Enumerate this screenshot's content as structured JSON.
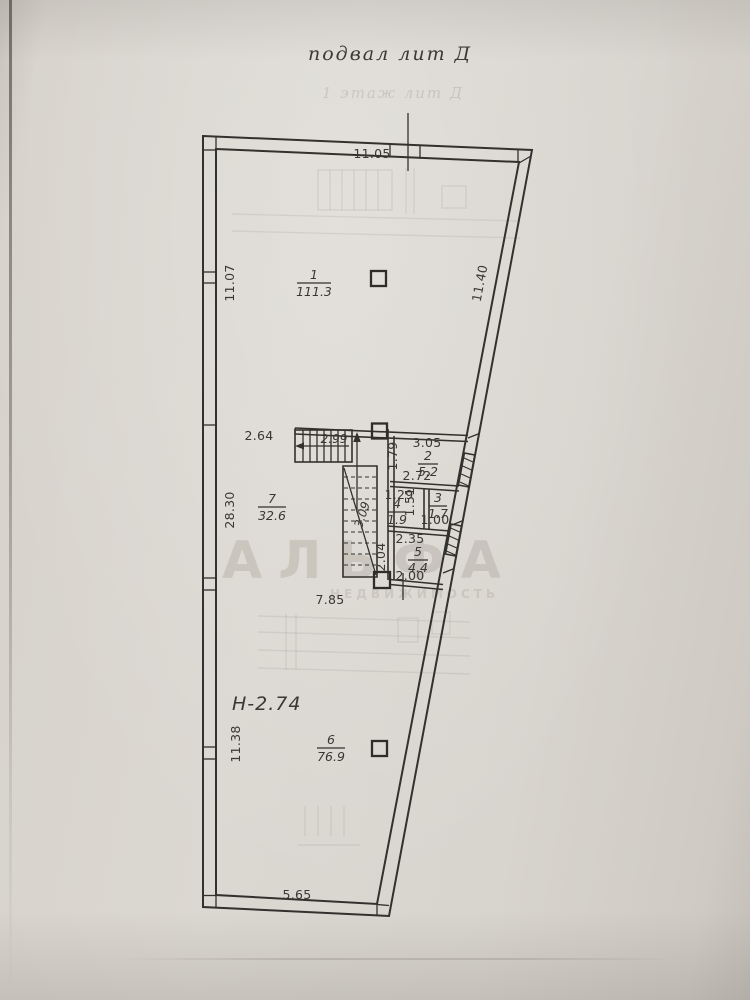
{
  "title": "подвал лит Д",
  "ghost": {
    "title": "1 этаж лит Д"
  },
  "watermark": {
    "line1": "АЛЬФА",
    "line2": "НЕДВИЖИМОСТЬ"
  },
  "notes": {
    "height": "Н-2.74"
  },
  "dims": {
    "top_width": "11.05",
    "left_upper": "11.07",
    "right_upper": "11.40",
    "left_mid": "28.30",
    "left_lower": "11.38",
    "bottom": "5.65",
    "corridor": "7.85",
    "room7_top": "2.64",
    "stairs_upper": "2.99",
    "stairs_lower": "3.09",
    "room2_w": "3.05",
    "room2_d": "1.79",
    "rooms34_w": "2.72",
    "room4_w": "1.29",
    "room4_d": "1.51",
    "room3_w": "1.00",
    "room5_w": "2.35",
    "room5_d": "2.04",
    "door": "2.00"
  },
  "rooms": [
    {
      "number": "1",
      "area": "111.3"
    },
    {
      "number": "2",
      "area": "5.2"
    },
    {
      "number": "3",
      "area": "1.7"
    },
    {
      "number": "4",
      "area": "1.9"
    },
    {
      "number": "5",
      "area": "4.4"
    },
    {
      "number": "6",
      "area": "76.9"
    },
    {
      "number": "7",
      "area": "32.6"
    }
  ],
  "colors": {
    "paper": "#d8d4ce",
    "ink": "#33312d",
    "watermark": "#a49e93"
  }
}
